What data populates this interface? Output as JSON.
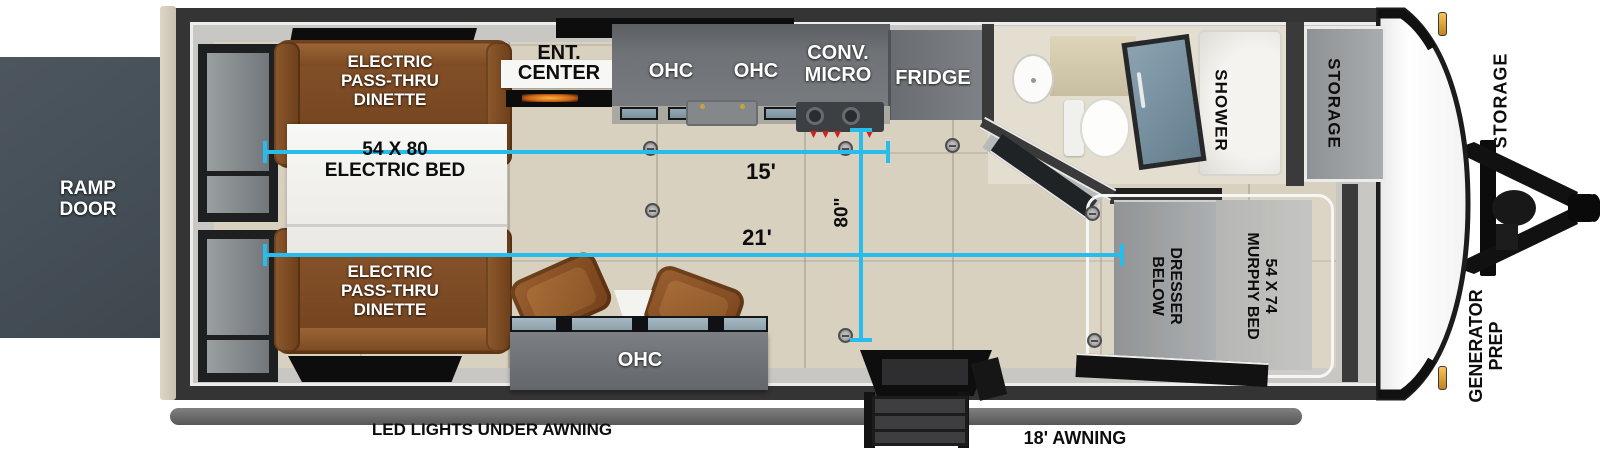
{
  "exterior": {
    "ramp_door": "RAMP\nDOOR",
    "led_lights": "LED LIGHTS UNDER AWNING",
    "awning": "18' AWNING",
    "storage_front": "STORAGE",
    "generator_prep": "GENERATOR\nPREP"
  },
  "garage": {
    "dinette_top": "ELECTRIC\nPASS-THRU\nDINETTE",
    "dinette_bottom": "ELECTRIC\nPASS-THRU\nDINETTE",
    "electric_bed": "54 X 80\nELECTRIC BED"
  },
  "kitchen": {
    "ent_line1": "ENT.",
    "ent_line2": "CENTER",
    "ohc_left": "OHC",
    "ohc_right": "OHC",
    "conv_micro": "CONV.\nMICRO",
    "fridge": "FRIDGE"
  },
  "living": {
    "ohc_bottom": "OHC"
  },
  "bathroom": {
    "shower": "SHOWER",
    "storage_interior": "STORAGE"
  },
  "bedroom": {
    "murphy_bed": "54 X 74\nMURPHY BED",
    "dresser": "DRESSER\nBELOW"
  },
  "dimensions": {
    "length_15": "15'",
    "length_21": "21'",
    "width_80": "80\""
  },
  "colors": {
    "accent_cyan": "#27bce9",
    "dinette_brown": "#7d4b23",
    "wall_dark": "#343434",
    "floor_beige": "#d8d1c0",
    "ramp_gray": "#465058"
  }
}
